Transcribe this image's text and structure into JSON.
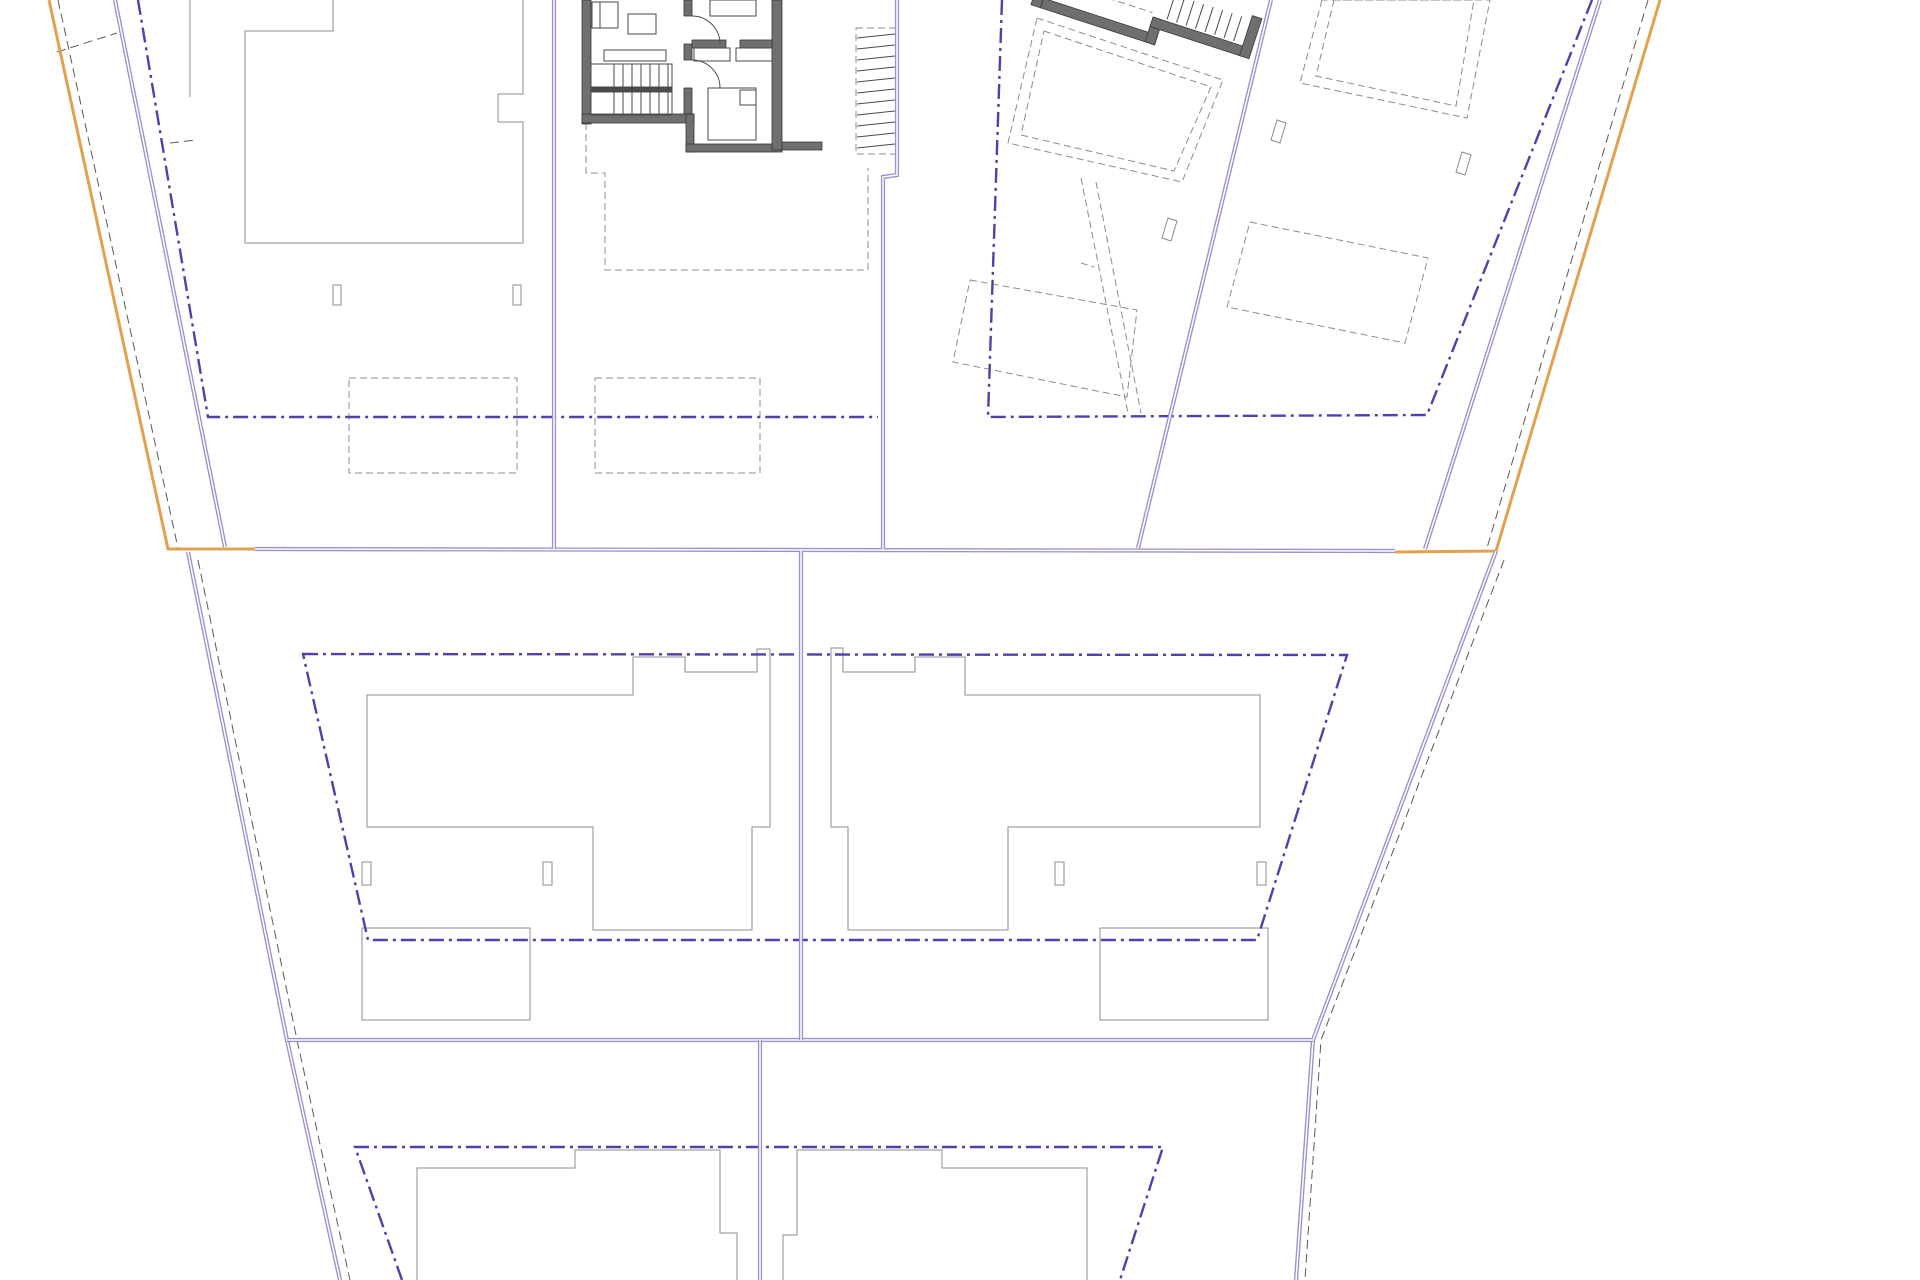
{
  "canvas": {
    "width": 1920,
    "height": 1280,
    "background": "#ffffff"
  },
  "colors": {
    "orange": "#E2A14E",
    "purple": "#9C90CC",
    "purple_core": "#FFFFFF",
    "dashdot_blue": "#4C42AC",
    "gray": "#8C8C8C",
    "dark": "#4A4A4A",
    "wall_fill": "#6F6F6F",
    "wall_edge": "#383838",
    "black_dash": "#5A5A5A"
  },
  "layers": [
    {
      "name": "thin-gray-outlines",
      "stroke": "gray",
      "width": 1,
      "items": [
        {
          "type": "polyline",
          "name": "house1-outline",
          "pts": [
            333,
            0,
            333,
            31,
            245,
            31,
            245,
            243,
            523,
            243,
            523,
            122,
            498,
            122,
            498,
            94,
            523,
            94,
            523,
            0
          ]
        },
        {
          "type": "line",
          "name": "fence-line",
          "x1": 190,
          "y1": 0,
          "x2": 190,
          "y2": 97
        },
        {
          "type": "rect",
          "name": "post",
          "x": 333,
          "y": 285,
          "w": 8,
          "h": 20
        },
        {
          "type": "rect",
          "name": "post",
          "x": 513,
          "y": 285,
          "w": 8,
          "h": 20
        },
        {
          "type": "polygon",
          "name": "house5-outline",
          "pts": [
            367,
            695,
            633,
            695,
            633,
            657,
            685,
            657,
            685,
            672,
            757,
            672,
            757,
            649,
            770,
            649,
            770,
            827,
            752,
            827,
            752,
            930,
            593,
            930,
            593,
            827,
            367,
            827
          ]
        },
        {
          "type": "rect",
          "name": "post",
          "x": 362,
          "y": 862,
          "w": 9,
          "h": 23
        },
        {
          "type": "rect",
          "name": "post",
          "x": 543,
          "y": 862,
          "w": 9,
          "h": 23
        },
        {
          "type": "rect",
          "name": "garage",
          "x": 362,
          "y": 928,
          "w": 168,
          "h": 92
        },
        {
          "type": "polygon",
          "name": "house6-outline",
          "pts": [
            831,
            648,
            843,
            648,
            843,
            672,
            915,
            672,
            915,
            657,
            965,
            657,
            965,
            695,
            1260,
            695,
            1260,
            827,
            1008,
            827,
            1008,
            930,
            848,
            930,
            848,
            827,
            831,
            827
          ]
        },
        {
          "type": "rect",
          "name": "post",
          "x": 1055,
          "y": 862,
          "w": 9,
          "h": 23
        },
        {
          "type": "rect",
          "name": "post",
          "x": 1257,
          "y": 862,
          "w": 9,
          "h": 23
        },
        {
          "type": "rect",
          "name": "garage",
          "x": 1100,
          "y": 928,
          "w": 168,
          "h": 92
        },
        {
          "type": "polyline",
          "name": "house7-outline",
          "pts": [
            417,
            1280,
            417,
            1168,
            575,
            1168,
            575,
            1150,
            720,
            1150,
            720,
            1233,
            737,
            1233,
            737,
            1280
          ]
        },
        {
          "type": "polyline",
          "name": "house8-outline",
          "pts": [
            783,
            1280,
            783,
            1235,
            797,
            1235,
            797,
            1150,
            942,
            1150,
            942,
            1168,
            1087,
            1168,
            1087,
            1280
          ]
        },
        {
          "type": "polygon",
          "name": "post-tilted",
          "pts": [
            1168,
            218,
            1177,
            221,
            1171,
            241,
            1162,
            238
          ]
        },
        {
          "type": "polygon",
          "name": "post-tilted",
          "pts": [
            1277,
            120,
            1286,
            123,
            1280,
            143,
            1271,
            140
          ]
        },
        {
          "type": "polygon",
          "name": "post-tilted",
          "pts": [
            1462,
            152,
            1471,
            155,
            1465,
            175,
            1456,
            172
          ]
        }
      ]
    },
    {
      "name": "dashed-gray-outlines",
      "stroke": "gray",
      "width": 1,
      "dash": "7 4",
      "items": [
        {
          "type": "rect",
          "name": "parking-pad",
          "x": 349,
          "y": 378,
          "w": 168,
          "h": 95
        },
        {
          "type": "rect",
          "name": "parking-pad",
          "x": 595,
          "y": 378,
          "w": 165,
          "h": 95
        },
        {
          "type": "polyline",
          "name": "house2-footprint",
          "pts": [
            586,
            123,
            586,
            173,
            605,
            173,
            605,
            270,
            868,
            270,
            868,
            168
          ]
        },
        {
          "type": "polygon",
          "name": "building2-footprint-outer",
          "pts": [
            1037,
            18,
            1223,
            80,
            1182,
            182,
            1008,
            143
          ]
        },
        {
          "type": "polygon",
          "name": "building2-footprint-inner",
          "pts": [
            1044,
            31,
            1211,
            87,
            1174,
            171,
            1021,
            135
          ]
        },
        {
          "type": "line",
          "name": "walkway-edge",
          "x1": 1081,
          "y1": 178,
          "x2": 1128,
          "y2": 413
        },
        {
          "type": "line",
          "name": "walkway-edge",
          "x1": 1096,
          "y1": 182,
          "x2": 1141,
          "y2": 413
        },
        {
          "type": "line",
          "name": "walkway-step",
          "x1": 1081,
          "y1": 263,
          "x2": 1094,
          "y2": 267
        },
        {
          "type": "polygon",
          "name": "pad-tilted",
          "pts": [
            970,
            280,
            1137,
            310,
            1127,
            397,
            953,
            362
          ]
        },
        {
          "type": "polygon",
          "name": "house4-outline-outer",
          "pts": [
            1322,
            0,
            1300,
            83,
            1467,
            118,
            1490,
            0
          ]
        },
        {
          "type": "polygon",
          "name": "house4-outline-inner",
          "pts": [
            1334,
            0,
            1316,
            76,
            1456,
            106,
            1474,
            0
          ]
        },
        {
          "type": "polygon",
          "name": "pad-tilted",
          "pts": [
            1250,
            222,
            1428,
            258,
            1405,
            343,
            1227,
            307
          ]
        },
        {
          "type": "rect",
          "name": "external-stair-frame",
          "x": 856,
          "y": 28,
          "w": 40,
          "h": 126
        },
        {
          "type": "line",
          "name": "building2-interior-line",
          "x1": 1048,
          "y1": -22,
          "x2": 1150,
          "y2": -22,
          "transform": "rotate(18 1042 3)"
        }
      ]
    },
    {
      "name": "black-dashed-companions",
      "stroke": "black_dash",
      "width": 1,
      "dash": "9 5",
      "items": [
        {
          "type": "line",
          "name": "boundary-companion",
          "x1": 58,
          "y1": 0,
          "x2": 178,
          "y2": 548
        },
        {
          "type": "line",
          "name": "boundary-companion",
          "x1": 1648,
          "y1": 0,
          "x2": 1487,
          "y2": 548
        },
        {
          "type": "polyline",
          "name": "boundary-companion",
          "pts": [
            198,
            560,
            297,
            1040,
            350,
            1280
          ]
        },
        {
          "type": "polyline",
          "name": "boundary-companion",
          "pts": [
            1504,
            560,
            1321,
            1040,
            1305,
            1280
          ]
        },
        {
          "type": "line",
          "name": "survey-tick",
          "x1": 57,
          "y1": 52,
          "x2": 117,
          "y2": 33
        },
        {
          "type": "line",
          "name": "survey-tick",
          "x1": 170,
          "y1": 143,
          "x2": 196,
          "y2": 140
        }
      ]
    },
    {
      "name": "setback-dashdot-lines",
      "stroke": "dashdot_blue",
      "width": 2.4,
      "dash": "15 5 3 5",
      "items": [
        {
          "type": "polyline",
          "name": "setback-plots-1-2",
          "pts": [
            138,
            0,
            208,
            417,
            878,
            417
          ]
        },
        {
          "type": "polyline",
          "name": "setback-plots-3-4",
          "pts": [
            1002,
            0,
            988,
            417,
            1427,
            415,
            1592,
            0
          ]
        },
        {
          "type": "polygon",
          "name": "setback-middle-band",
          "pts": [
            303,
            654,
            1347,
            655,
            1257,
            940,
            368,
            940
          ]
        },
        {
          "type": "polyline",
          "name": "setback-bottom-band",
          "pts": [
            402,
            1280,
            355,
            1147,
            1163,
            1147,
            1120,
            1280
          ]
        }
      ]
    },
    {
      "name": "site-boundary-orange",
      "stroke": "orange",
      "width": 3,
      "items": [
        {
          "type": "polyline",
          "name": "orange-boundary-left",
          "pts": [
            49,
            0,
            168,
            549,
            255,
            549
          ]
        },
        {
          "type": "polyline",
          "name": "orange-boundary-right",
          "pts": [
            1660,
            0,
            1496,
            551,
            1395,
            552
          ]
        }
      ]
    },
    {
      "name": "plot-boundaries-purple",
      "stroke": "purple",
      "width": 4.2,
      "double": true,
      "core": "purple_core",
      "core_width": 1.5,
      "items": [
        {
          "type": "line",
          "name": "inner-boundary-left",
          "x1": 115,
          "y1": 0,
          "x2": 225,
          "y2": 547
        },
        {
          "type": "line",
          "name": "inner-boundary-right",
          "x1": 1600,
          "y1": 0,
          "x2": 1425,
          "y2": 549
        },
        {
          "type": "polyline",
          "name": "boundary-lower-left",
          "pts": [
            188,
            552,
            287,
            1040,
            340,
            1280
          ]
        },
        {
          "type": "polyline",
          "name": "boundary-lower-right",
          "pts": [
            1496,
            551,
            1313,
            1040,
            1296,
            1280
          ]
        },
        {
          "type": "line",
          "name": "band-divider-top",
          "x1": 255,
          "y1": 549,
          "x2": 1395,
          "y2": 551
        },
        {
          "type": "line",
          "name": "band-divider-bottom",
          "x1": 287,
          "y1": 1040,
          "x2": 1313,
          "y2": 1040
        },
        {
          "type": "line",
          "name": "plot-divider-1",
          "x1": 554,
          "y1": 0,
          "x2": 554,
          "y2": 549
        },
        {
          "type": "polyline",
          "name": "plot-divider-2",
          "pts": [
            897,
            0,
            897,
            175,
            883,
            177,
            883,
            549
          ]
        },
        {
          "type": "line",
          "name": "plot-divider-3",
          "x1": 1271,
          "y1": 0,
          "x2": 1138,
          "y2": 548
        },
        {
          "type": "line",
          "name": "middle-band-divider",
          "x1": 801,
          "y1": 551,
          "x2": 801,
          "y2": 1040
        },
        {
          "type": "line",
          "name": "bottom-band-divider",
          "x1": 760,
          "y1": 1040,
          "x2": 760,
          "y2": 1280
        }
      ]
    },
    {
      "name": "building1-walls",
      "stroke": "wall_edge",
      "width": 0.8,
      "fill": "wall_fill",
      "items": [
        {
          "type": "rect",
          "name": "wall",
          "x": 582,
          "y": 0,
          "w": 9,
          "h": 124
        },
        {
          "type": "rect",
          "name": "wall",
          "x": 582,
          "y": 114,
          "w": 112,
          "h": 9
        },
        {
          "type": "rect",
          "name": "wall",
          "x": 686,
          "y": 114,
          "w": 8,
          "h": 38
        },
        {
          "type": "rect",
          "name": "wall",
          "x": 686,
          "y": 144,
          "w": 96,
          "h": 8
        },
        {
          "type": "rect",
          "name": "wall",
          "x": 772,
          "y": 0,
          "w": 10,
          "h": 150
        },
        {
          "type": "rect",
          "name": "wall",
          "x": 782,
          "y": 142,
          "w": 40,
          "h": 8
        },
        {
          "type": "rect",
          "name": "wall",
          "x": 684,
          "y": 0,
          "w": 8,
          "h": 16
        },
        {
          "type": "rect",
          "name": "wall",
          "x": 684,
          "y": 44,
          "w": 8,
          "h": 16
        },
        {
          "type": "rect",
          "name": "wall",
          "x": 684,
          "y": 88,
          "w": 8,
          "h": 26
        },
        {
          "type": "rect",
          "name": "wall",
          "x": 692,
          "y": 40,
          "w": 34,
          "h": 8
        },
        {
          "type": "rect",
          "name": "wall",
          "x": 740,
          "y": 40,
          "w": 32,
          "h": 8
        },
        {
          "type": "rect",
          "name": "wall",
          "x": 1042,
          "y": -2,
          "w": 120,
          "h": 10,
          "transform": "rotate(18 1042 3)"
        },
        {
          "type": "rect",
          "name": "wall",
          "x": 1152,
          "y": -18,
          "w": 10,
          "h": 26,
          "transform": "rotate(18 1042 3)"
        },
        {
          "type": "rect",
          "name": "wall",
          "x": 1152,
          "y": -18,
          "w": 104,
          "h": 10,
          "transform": "rotate(18 1042 3)"
        },
        {
          "type": "rect",
          "name": "wall",
          "x": 1246,
          "y": -50,
          "w": 10,
          "h": 42,
          "transform": "rotate(18 1042 3)"
        },
        {
          "type": "rect",
          "name": "wall",
          "x": 1032,
          "y": -34,
          "w": 10,
          "h": 42,
          "transform": "rotate(18 1042 3)"
        }
      ]
    },
    {
      "name": "building1-interior",
      "stroke": "dark",
      "width": 1,
      "items": [
        {
          "type": "rect",
          "name": "stair-frame",
          "x": 591,
          "y": 64,
          "w": 81,
          "h": 51
        },
        {
          "type": "hatch",
          "name": "stair-treads",
          "from": [
            614,
            64
          ],
          "step": [
            9,
            0
          ],
          "len": [
            0,
            51
          ],
          "count": 7
        },
        {
          "type": "rect",
          "name": "stair-rail",
          "x": 591,
          "y": 87,
          "w": 81,
          "h": 5,
          "fill": "dark"
        },
        {
          "type": "rect",
          "name": "bench",
          "x": 604,
          "y": 50,
          "w": 62,
          "h": 11
        },
        {
          "type": "rect",
          "name": "sofa",
          "x": 592,
          "y": 2,
          "w": 26,
          "h": 26
        },
        {
          "type": "line",
          "name": "sofa-line",
          "x1": 600,
          "y1": 2,
          "x2": 600,
          "y2": 28
        },
        {
          "type": "rect",
          "name": "table",
          "x": 628,
          "y": 14,
          "w": 28,
          "h": 20
        },
        {
          "type": "rect",
          "name": "wardrobe",
          "x": 694,
          "y": 48,
          "w": 36,
          "h": 13
        },
        {
          "type": "rect",
          "name": "wardrobe",
          "x": 736,
          "y": 48,
          "w": 36,
          "h": 13
        },
        {
          "type": "rect",
          "name": "bed",
          "x": 710,
          "y": 0,
          "w": 46,
          "h": 16
        },
        {
          "type": "rect",
          "name": "bed",
          "x": 708,
          "y": 88,
          "w": 48,
          "h": 52
        },
        {
          "type": "rect",
          "name": "pillow",
          "x": 740,
          "y": 90,
          "w": 16,
          "h": 15
        },
        {
          "type": "path",
          "name": "door-arc",
          "d": "M 692 16 A 28 28 0 0 1 720 44"
        },
        {
          "type": "path",
          "name": "door-arc",
          "d": "M 692 60 A 28 28 0 0 1 720 88"
        },
        {
          "type": "hatch",
          "name": "external-stair-treads",
          "from": [
            857,
            38
          ],
          "step": [
            0,
            11
          ],
          "len": [
            38,
            -4
          ],
          "count": 11
        },
        {
          "type": "hatch",
          "name": "building2-stair-treads",
          "from": [
            1166,
            -46
          ],
          "step": [
            10,
            0
          ],
          "len": [
            0,
            26
          ],
          "count": 8,
          "transform": "rotate(18 1042 3)"
        }
      ]
    }
  ]
}
